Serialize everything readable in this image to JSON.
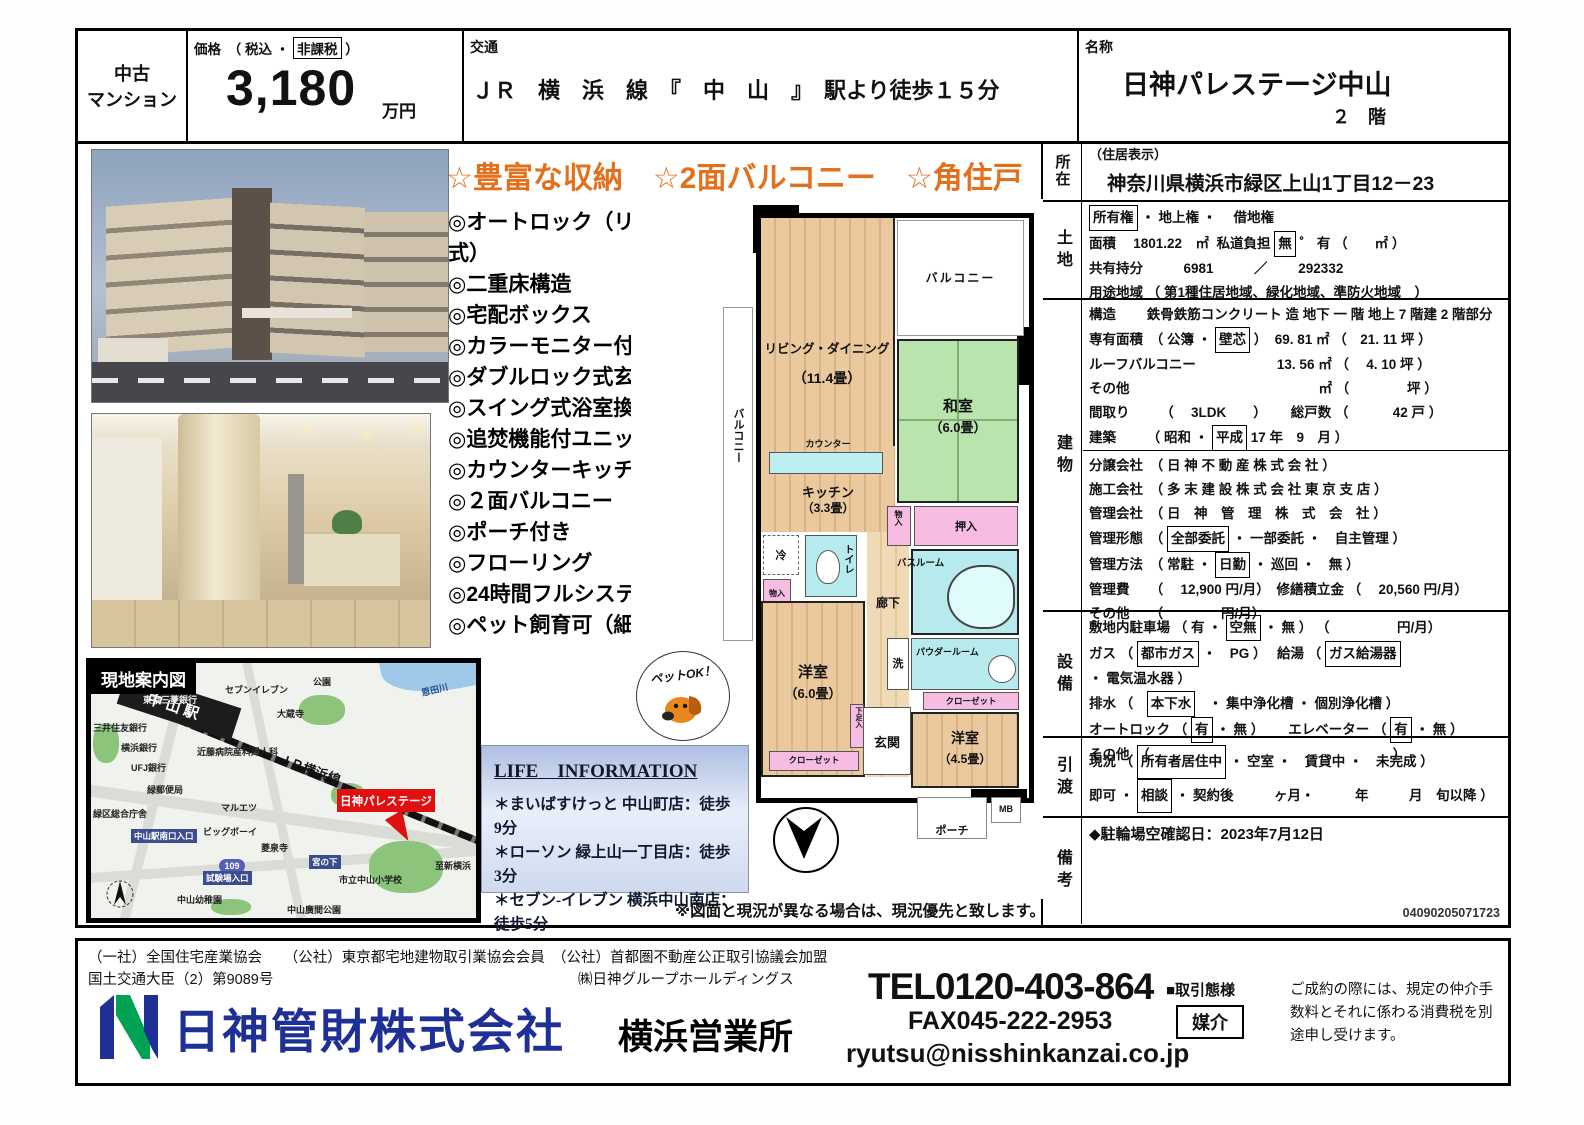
{
  "header": {
    "type1": "中古",
    "type2": "マンション",
    "price_label": [
      {
        "t": "価格　（ 税込 ・ "
      },
      {
        "t": "非課税",
        "box": true
      },
      {
        "t": " ）"
      }
    ],
    "price_value": "3,180",
    "price_unit": "万円",
    "access_label": "交通",
    "access_value": "ＪＲ　横　浜　線　『　中　山　』　駅より徒歩１５分",
    "name_label": "名称",
    "name_value": "日神パレステージ中山",
    "name_floor": "２　階"
  },
  "highlights": "☆豊富な収納　☆2面バルコニー　☆角住戸",
  "features": [
    "◎オートロック（リモコンキー方式）",
    "◎二重床構造",
    "◎宅配ボックス",
    "◎カラーモニター付インターホン",
    "◎ダブルロック式玄関ドア",
    "◎スイング式浴室換気乾燥機",
    "◎追焚機能付ユニットバス",
    "◎カウンターキッチン",
    "◎２面バルコニー",
    "◎ポーチ付き",
    "◎フローリング",
    "◎24時間フルシステム管理",
    "◎ペット飼育可（細則あり）"
  ],
  "floorplan": {
    "living": "リビング・ダイニング",
    "living_size": "（11.4畳）",
    "kitchen": "キッチン",
    "kitchen_size": "（3.3畳）",
    "counter": "カウンター",
    "washitsu": "和室",
    "washitsu_size": "（6.0畳）",
    "youshitsu1": "洋室",
    "youshitsu1_size": "（6.0畳）",
    "youshitsu2": "洋室",
    "youshitsu2_size": "（4.5畳）",
    "balcony_top": "バルコニー",
    "balcony_left": "バルコニー",
    "oshiire": "押入",
    "monoire1": "物入",
    "monoire2": "物入",
    "bathroom": "バスルーム",
    "powder": "パウダールーム",
    "laundry": "洗",
    "toilet": "トイレ",
    "fridge": "冷",
    "closet1": "クローゼット",
    "closet2": "クローゼット",
    "hallway": "廊下",
    "genkan": "玄関",
    "geta": "下足入",
    "porch": "ポーチ",
    "mb": "MB",
    "pet_ok": "ペットOK！"
  },
  "life": {
    "title": "LIFE　INFORMATION",
    "items": [
      "＊まいばすけっと 中山町店：徒歩9分",
      "＊ローソン 緑上山一丁目店：徒歩3分",
      "＊セブン-イレブン 横浜中山南店：徒歩5分",
      "＊横浜白山郵便局：徒歩7分"
    ]
  },
  "disclaimer": "※図面と現況が異なる場合は、現況優先と致します。",
  "map": {
    "title": "現地案内図",
    "station": "中山駅",
    "rail": "ＪＲ横浜線",
    "property": "日神パレステージ",
    "route_badge": "109",
    "labels": [
      "東京三菱銀行",
      "セブンイレブン",
      "公園",
      "大蔵寺",
      "恩田川",
      "三井住友銀行",
      "横浜銀行",
      "近藤病院産科婦人科",
      "UFJ銀行",
      "緑郵便局",
      "マルエツ",
      "緑区総合庁舎",
      "中山駅南口入口",
      "ビッグボーイ",
      "試験場入口",
      "宮の下",
      "菱泉寺",
      "市立中山小学校",
      "中山幼稚園",
      "中山廣間公園",
      "至新横浜"
    ]
  },
  "details": {
    "shozai_label": "所在",
    "shozai_sub": "（住居表示）",
    "shozai_address": "神奈川県横浜市緑区上山1丁目12－23",
    "tochi_label": "土地",
    "tochi_rows": [
      [
        {
          "t": "所有権",
          "box": true
        },
        {
          "t": " ・ 地上権 ・　 借地権"
        }
      ],
      [
        {
          "t": "面積　 1801.22　㎡  私道負担 "
        },
        {
          "t": "無",
          "box": true
        },
        {
          "t": " ゜ 有 （　　㎡ ）"
        }
      ],
      [
        {
          "t": "共有持分　　　6981　　　／　　 292332"
        }
      ],
      [
        {
          "t": "用途地域 （ 第1種住居地域、緑化地域、準防火地域　）"
        }
      ]
    ],
    "tatemono_label": "建物",
    "tatemono_a": [
      [
        {
          "t": "構造　　 鉄骨鉄筋コンクリート 造 地下 一 階 地上 7 階建 2 階部分"
        }
      ],
      [
        {
          "t": "専有面積　（ 公簿 ・ "
        },
        {
          "t": "壁芯",
          "box": true
        },
        {
          "t": " ）  69. 81 ㎡ （　21. 11 坪 ）"
        }
      ],
      [
        {
          "t": "ルーフバルコニー　　　　　　13. 56 ㎡ （　 4. 10 坪 ）"
        }
      ],
      [
        {
          "t": "その他　　　　　　　　　　　　　　㎡ （　　　　 坪 ）"
        }
      ],
      [
        {
          "t": "間取り　　 （　 3LDK　　）　　 総戸数 （　　　 42 戸 ）"
        }
      ],
      [
        {
          "t": "建築　　 （ 昭和 ・ "
        },
        {
          "t": "平成",
          "box": true
        },
        {
          "t": " 17 年　9　月 ）"
        }
      ]
    ],
    "tatemono_b": [
      [
        {
          "t": "分譲会社　（ 日 神 不 動 産 株 式 会 社 ）"
        }
      ],
      [
        {
          "t": "施工会社　（ 多 末 建 設 株 式 会 社 東 京 支 店 ）"
        }
      ],
      [
        {
          "t": "管理会社　（ 日　神　管　理　株　式　会　社 ）"
        }
      ],
      [
        {
          "t": "管理形態　（ "
        },
        {
          "t": "全部委託",
          "box": true
        },
        {
          "t": " ・ 一部委託 ・　自主管理 ）"
        }
      ],
      [
        {
          "t": "管理方法　（ 常駐 ・ "
        },
        {
          "t": "日勤",
          "box": true
        },
        {
          "t": " ・ 巡回 ・　無 ）"
        }
      ],
      [
        {
          "t": "管理費　　（　 12,900 円/月）　修繕積立金 （　 20,560 円/月）"
        }
      ],
      [
        {
          "t": "その他　　（　　　　 円/月）"
        }
      ]
    ],
    "setsubi_label": "設備",
    "setsubi_rows": [
      [
        {
          "t": "敷地内駐車場 （ 有 ・ "
        },
        {
          "t": "空無",
          "box": true
        },
        {
          "t": " ・ 無 ） （　　　　　円/月）"
        }
      ],
      [
        {
          "t": "ガス （ "
        },
        {
          "t": "都市ガス",
          "box": true
        },
        {
          "t": " ・　PG ）　 給湯 （ "
        },
        {
          "t": "ガス給湯器",
          "box": true
        },
        {
          "t": " ・ 電気温水器 ）"
        }
      ],
      [
        {
          "t": "排水 （　"
        },
        {
          "t": "本下水",
          "box": true
        },
        {
          "t": "　・ 集中浄化槽 ・ 個別浄化槽 ）"
        }
      ],
      [
        {
          "t": "オートロック （ "
        },
        {
          "t": "有",
          "box": true
        },
        {
          "t": " ・ 無 ）　　 エレベーター （ "
        },
        {
          "t": "有",
          "box": true
        },
        {
          "t": " ・ 無 ）"
        }
      ],
      [
        {
          "t": "その他　（　　　　　　　　　　　　　　　　　　）"
        }
      ]
    ],
    "hikiwatashi_label": "引渡",
    "hikiwatashi_rows": [
      [
        {
          "t": "現況 （ "
        },
        {
          "t": "所有者居住中",
          "box": true
        },
        {
          "t": " ・ 空室 ・　賃貸中 ・　未完成 ）"
        }
      ],
      [
        {
          "t": "即可 ・ "
        },
        {
          "t": "相談",
          "box": true
        },
        {
          "t": " ・ 契約後　　　ヶ月・　　　年　　　月　旬以降 ）"
        }
      ]
    ],
    "bikou_label": "備考",
    "bikou_text": "◆駐輪場空確認日：2023年7月12日",
    "bikou_code": "04090205071723"
  },
  "footer": {
    "assoc1": "（一社）全国住宅産業協会　　（公社）東京都宅地建物取引業協会会員　（公社）首都圏不動産公正取引協議会加盟",
    "assoc2": "国土交通大臣（2）第9089号",
    "holding": "㈱日神グループホールディングス",
    "company": "日神管財株式会社",
    "office": "横浜営業所",
    "tel": "TEL0120-403-864",
    "fax": "FAX045-222-2953",
    "email": "ryutsu@nisshinkanzai.co.jp",
    "dealtype_label": "■取引態様",
    "dealtype_value": "媒介",
    "note": "ご成約の際には、規定の仲介手数料とそれに係わる消費税を別途申し受けます。"
  },
  "colors": {
    "highlight_orange": "#e2711d",
    "logo_blue": "#1e2f96",
    "logo_green": "#00a254",
    "map_red": "#e01010",
    "tatami_green": "#b9e4ad",
    "wet_cyan": "#b7eaec",
    "closet_pink": "#f6bce2"
  }
}
